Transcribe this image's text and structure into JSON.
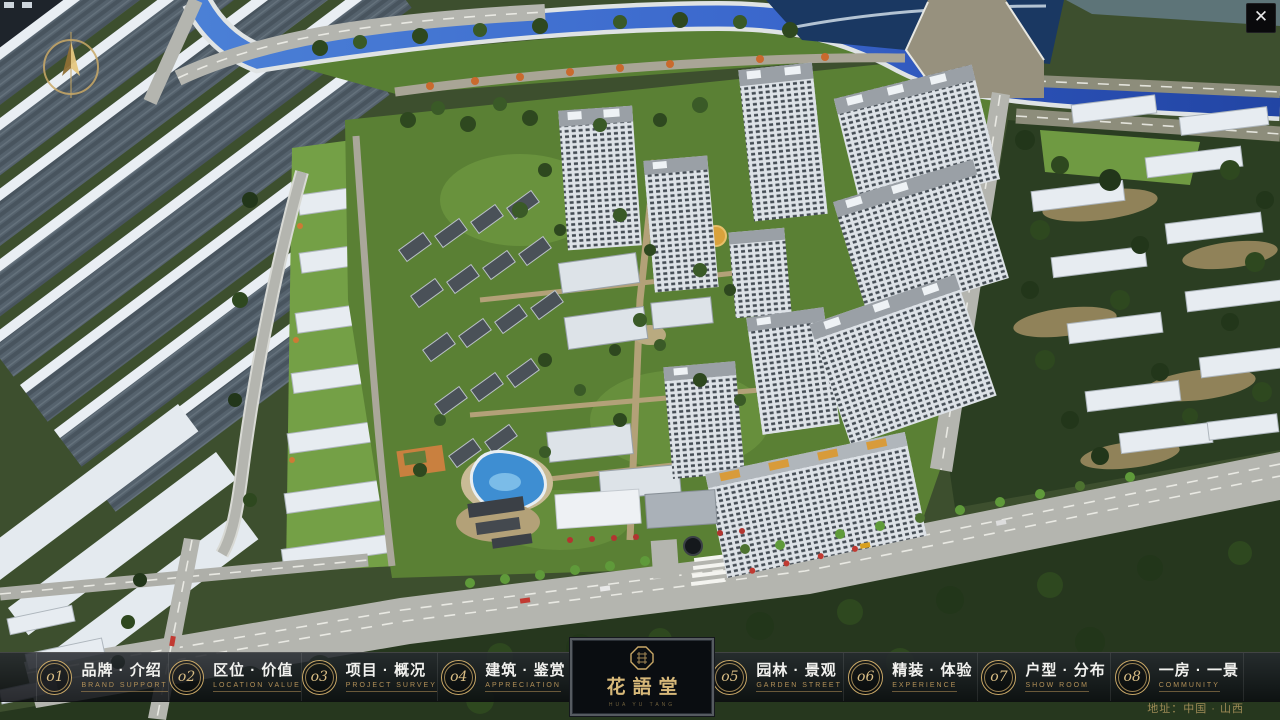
{
  "window": {
    "close": "✕"
  },
  "logo": {
    "title": "花語堂",
    "subtitle": "HUA YU TANG"
  },
  "navbar": {
    "address": "地址：中国 · 山西",
    "items": [
      {
        "num": "o1",
        "zh": "品牌 · 介绍",
        "en": "BRAND SUPPORT"
      },
      {
        "num": "o2",
        "zh": "区位 · 价值",
        "en": "LOCATION VALUE"
      },
      {
        "num": "o3",
        "zh": "项目 · 概况",
        "en": "PROJECT SURVEY"
      },
      {
        "num": "o4",
        "zh": "建筑 · 鉴赏",
        "en": "APPRECIATION"
      },
      {
        "num": "o5",
        "zh": "园林 · 景观",
        "en": "GARDEN STREET"
      },
      {
        "num": "o6",
        "zh": "精装 · 体验",
        "en": "EXPERIENCE"
      },
      {
        "num": "o7",
        "zh": "户型 · 分布",
        "en": "SHOW ROOM"
      },
      {
        "num": "o8",
        "zh": "一房 · 一景",
        "en": "COMMUNITY"
      }
    ]
  },
  "colors": {
    "gold": "#c9a867",
    "bar_bg": "#14171c",
    "canal_blue": "#3a66cc",
    "lawn_green": "#66903e"
  }
}
